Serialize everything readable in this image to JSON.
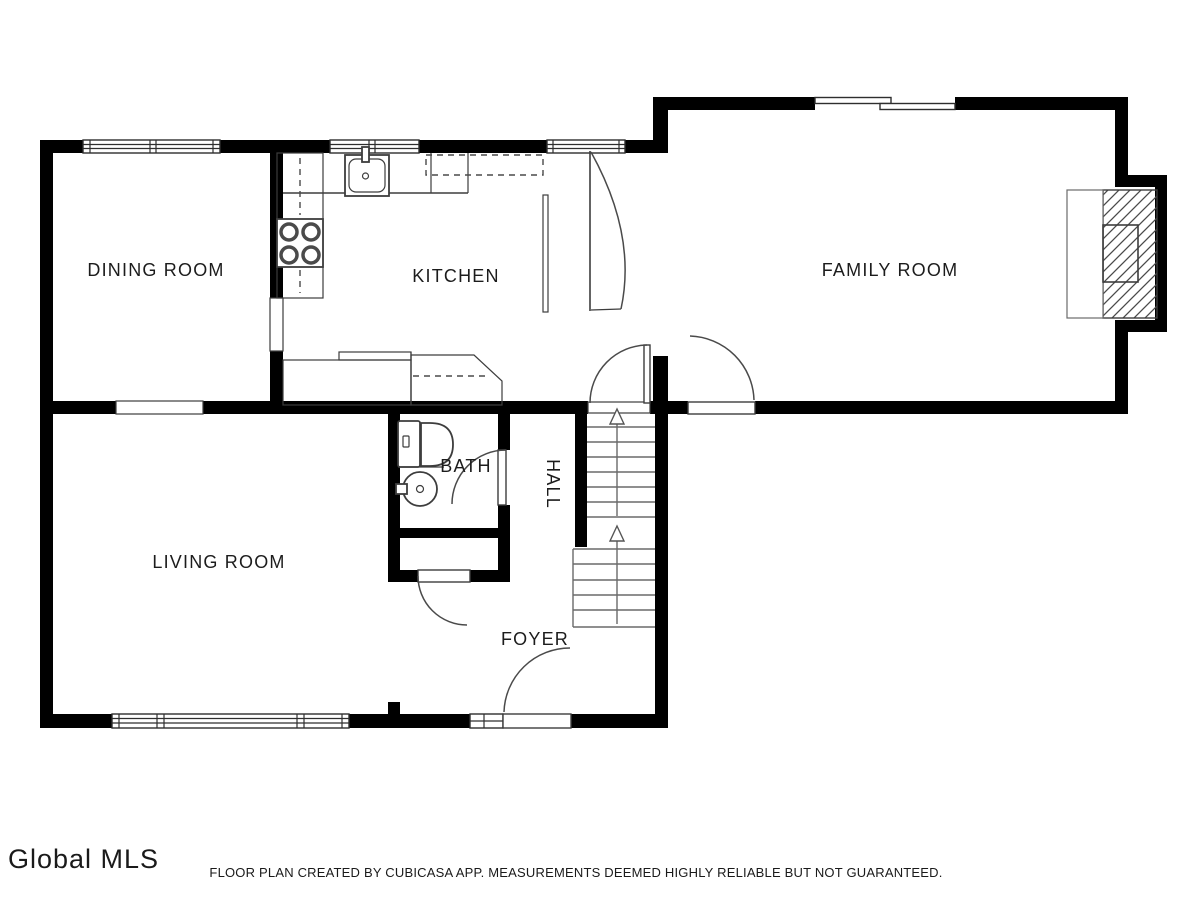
{
  "plan": {
    "type": "floor-plan",
    "rooms": {
      "dining_room": "DINING ROOM",
      "kitchen": "KITCHEN",
      "family_room": "FAMILY ROOM",
      "living_room": "LIVING ROOM",
      "bath": "BATH",
      "hall": "HALL",
      "foyer": "FOYER"
    },
    "stairs": {
      "direction": "up",
      "flights": 2
    }
  },
  "footer": {
    "logo": "Global MLS",
    "disclaimer": "FLOOR PLAN CREATED BY CUBICASA APP. MEASUREMENTS DEEMED HIGHLY RELIABLE BUT NOT GUARANTEED."
  },
  "colors": {
    "wall": "#000000",
    "line": "#3d3d3d",
    "background": "#ffffff",
    "text": "#1c1c1c"
  }
}
